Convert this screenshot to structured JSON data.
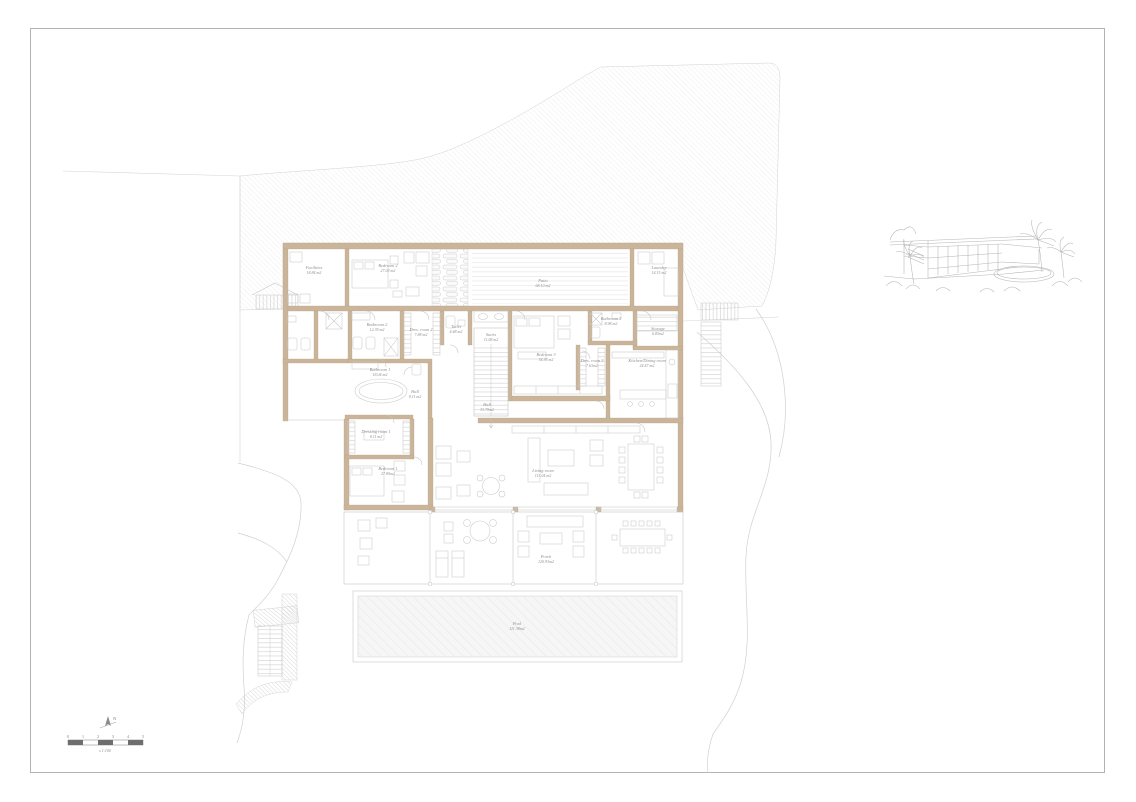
{
  "sheet": {
    "north_label": "N",
    "scale_bar": {
      "ticks": [
        "0",
        "1",
        "2",
        "3",
        "4",
        "5"
      ],
      "caption": "s 1:100"
    }
  },
  "rooms": [
    {
      "name": "Facilities",
      "area": "18.84 m2"
    },
    {
      "name": "Bedroom 2",
      "area": "27.03 m2"
    },
    {
      "name": "Patio",
      "area": "68.10 m2"
    },
    {
      "name": "Laundry",
      "area": "14.15 m2"
    },
    {
      "name": "Bathroom 2",
      "area": "12.39 m2"
    },
    {
      "name": "Dres. room 2",
      "area": "7.88 m2"
    },
    {
      "name": "Toilet",
      "area": "4.48 m2"
    },
    {
      "name": "Stairs",
      "area": "11.08 m2"
    },
    {
      "name": "Bedroom 3",
      "area": "34.38 m2"
    },
    {
      "name": "Bathroom 3",
      "area": "8.98 m2"
    },
    {
      "name": "Storage",
      "area": "6.85m2"
    },
    {
      "name": "Dres. room 3",
      "area": "7.63m2"
    },
    {
      "name": "Kitchen/Dining room",
      "area": "24.47 m2"
    },
    {
      "name": "Bathroom 1",
      "area": "18.04 m2"
    },
    {
      "name": "Hall",
      "area": "9.11 m2"
    },
    {
      "name": "Hall",
      "area": "33.79m2"
    },
    {
      "name": "Dressing room 1",
      "area": "8.11 m2"
    },
    {
      "name": "Bedroom 1",
      "area": "27.80m2"
    },
    {
      "name": "Living room",
      "area": "113.04 m2"
    },
    {
      "name": "Porch",
      "area": "120.93m2"
    },
    {
      "name": "Pool",
      "area": "111.38m2"
    }
  ],
  "colors": {
    "wall": "#cbb59a",
    "wall_edge": "#b7a084",
    "thin_line": "#c4c4c4",
    "terrain_hatch": "#dedede",
    "label_text": "#8f8f8f",
    "paper": "#ffffff"
  }
}
